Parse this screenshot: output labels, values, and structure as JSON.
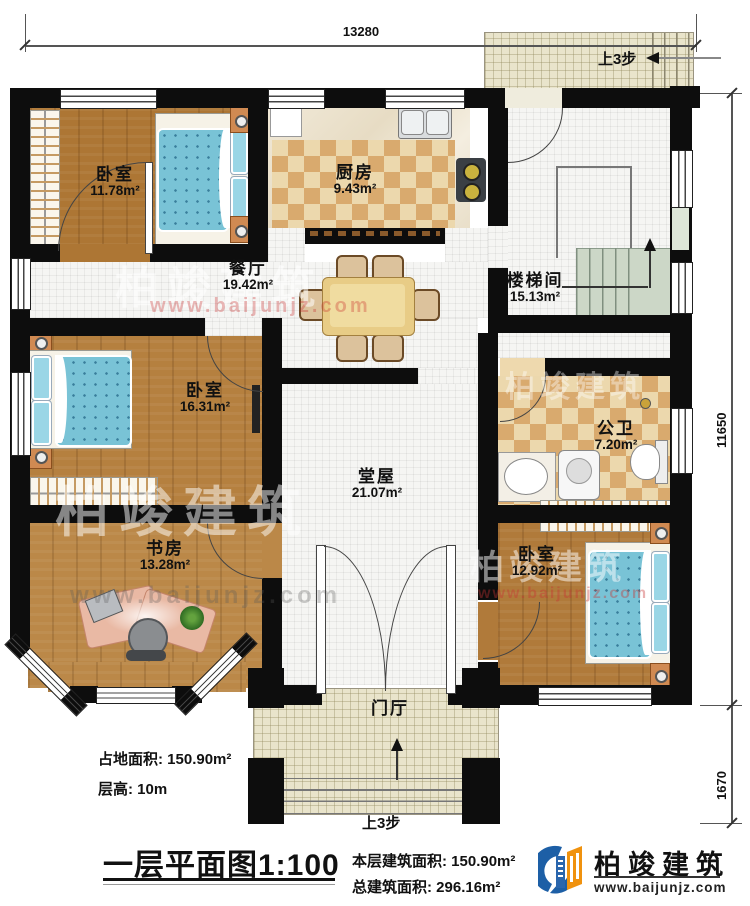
{
  "dimensions": {
    "top": "13280",
    "right_upper": "11650",
    "right_lower": "1670"
  },
  "annotations": {
    "steps_up_top": "上3步",
    "steps_up_bottom": "上3步"
  },
  "rooms": {
    "bedroom1": {
      "name": "卧室",
      "area": "11.78m²"
    },
    "kitchen": {
      "name": "厨房",
      "area": "9.43m²"
    },
    "stairwell": {
      "name": "楼梯间",
      "area": "15.13m²"
    },
    "dining": {
      "name": "餐厅",
      "area": "19.42m²"
    },
    "bedroom2": {
      "name": "卧室",
      "area": "16.31m²"
    },
    "bathroom": {
      "name": "公卫",
      "area": "7.20m²"
    },
    "hall": {
      "name": "堂屋",
      "area": "21.07m²"
    },
    "study": {
      "name": "书房",
      "area": "13.28m²"
    },
    "bedroom3": {
      "name": "卧室",
      "area": "12.92m²"
    },
    "foyer": {
      "name": "门厅"
    }
  },
  "footer": {
    "land_area_label": "占地面积:",
    "land_area_value": "150.90m²",
    "floor_height_label": "层高:",
    "floor_height_value": "10m",
    "plan_title": "一层平面图",
    "plan_scale": "1:100",
    "floor_area_label": "本层建筑面积:",
    "floor_area_value": "150.90m²",
    "total_area_label": "总建筑面积:",
    "total_area_value": "296.16m²"
  },
  "brand": {
    "name": "柏竣建筑",
    "url": "www.baijunjz.com"
  },
  "watermark": {
    "name": "柏竣建筑",
    "url": "www.baijunjz.com"
  },
  "colors": {
    "wall": "#0d0d0d",
    "wood": "#b17a3a",
    "checker_light": "#ecd8ad",
    "checker_dark": "#d9aa6e",
    "bed_blue": "#79c3d6",
    "brand_blue": "#1d5fa6",
    "brand_orange": "#f0920e"
  }
}
